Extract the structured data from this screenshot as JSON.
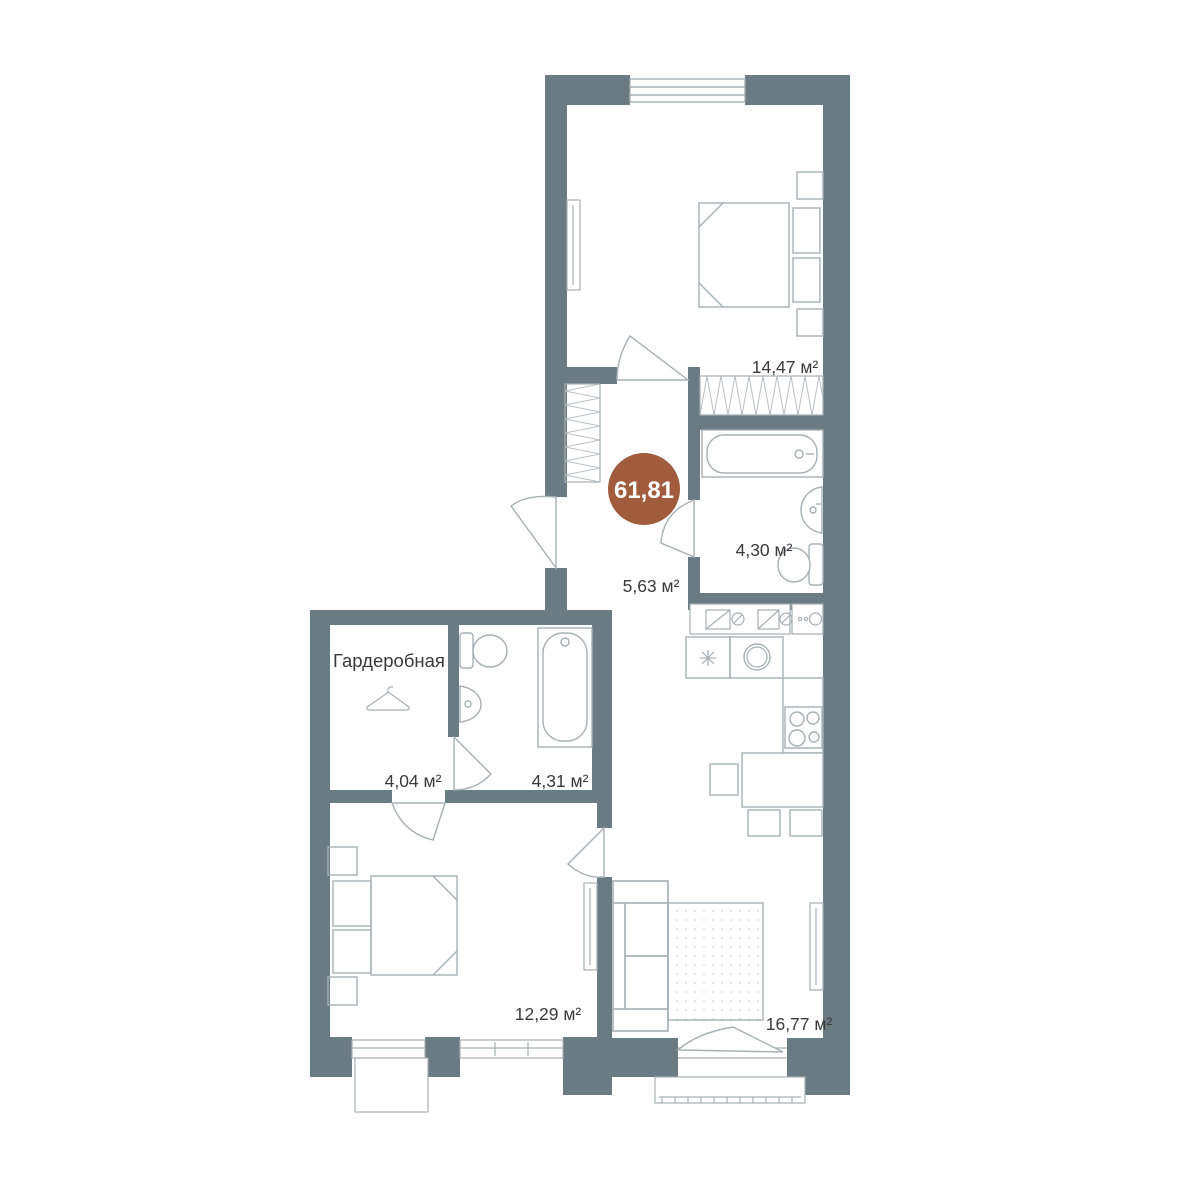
{
  "plan": {
    "total_area_badge": "61,81",
    "labels": {
      "bedroom_top": "14,47 м²",
      "bathroom_top": "4,30 м²",
      "hallway": "5,63 м²",
      "wardrobe_title": "Гардеробная",
      "wardrobe_area": "4,04 м²",
      "bathroom_small": "4,31 м²",
      "bedroom_bottom": "12,29 м²",
      "living_kitchen": "16,77 м²"
    },
    "colors": {
      "wall": "#6b7b83",
      "accent_circle": "#a15c3d",
      "furniture_line": "#a6b0b5",
      "hatch_line": "#b9c0c5",
      "label_text": "#3a3a3a"
    }
  }
}
